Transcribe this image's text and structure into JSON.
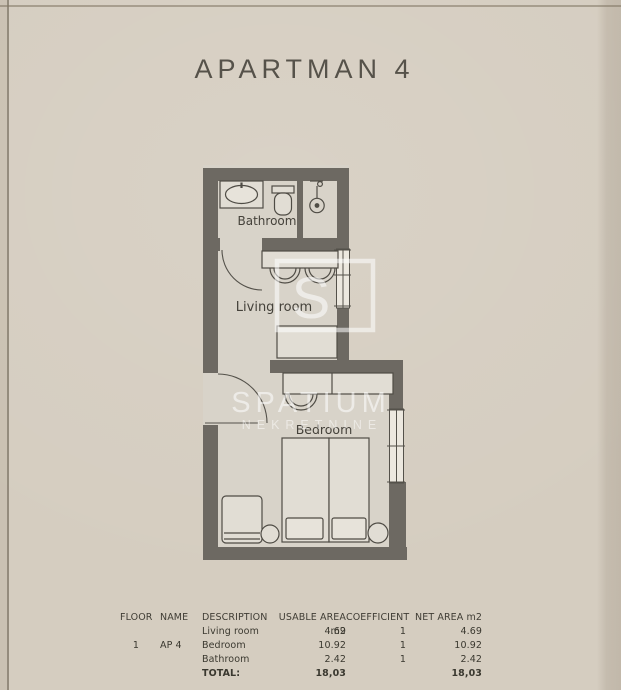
{
  "page": {
    "title": "APARTMAN 4"
  },
  "floor_plan": {
    "labels": {
      "bathroom": "Bathroom",
      "living_room": "Living room",
      "bedroom": "Bedroom"
    },
    "colors": {
      "wall": "#6d6962",
      "room_fill": "#d8d3c9",
      "furniture_fill": "#e1ddd4",
      "outline": "#4f4c45",
      "paper": "#d5cdc0"
    }
  },
  "watermark": {
    "logo_letter": "S",
    "brand": "SPATIUM",
    "subbrand": "NEKRETNINE"
  },
  "table": {
    "headers": [
      "FLOOR",
      "NAME",
      "DESCRIPTION",
      "USABLE AREA m2",
      "COEFFICIENT",
      "NET AREA m2"
    ],
    "rows": [
      {
        "floor": "",
        "name": "",
        "description": "Living room",
        "usable_area": "4.69",
        "coefficient": "1",
        "net_area": "4.69"
      },
      {
        "floor": "1",
        "name": "AP 4",
        "description": "Bedroom",
        "usable_area": "10.92",
        "coefficient": "1",
        "net_area": "10.92"
      },
      {
        "floor": "",
        "name": "",
        "description": "Bathroom",
        "usable_area": "2.42",
        "coefficient": "1",
        "net_area": "2.42"
      }
    ],
    "total": {
      "label": "TOTAL:",
      "usable_area": "18,03",
      "coefficient": "",
      "net_area": "18,03"
    }
  }
}
